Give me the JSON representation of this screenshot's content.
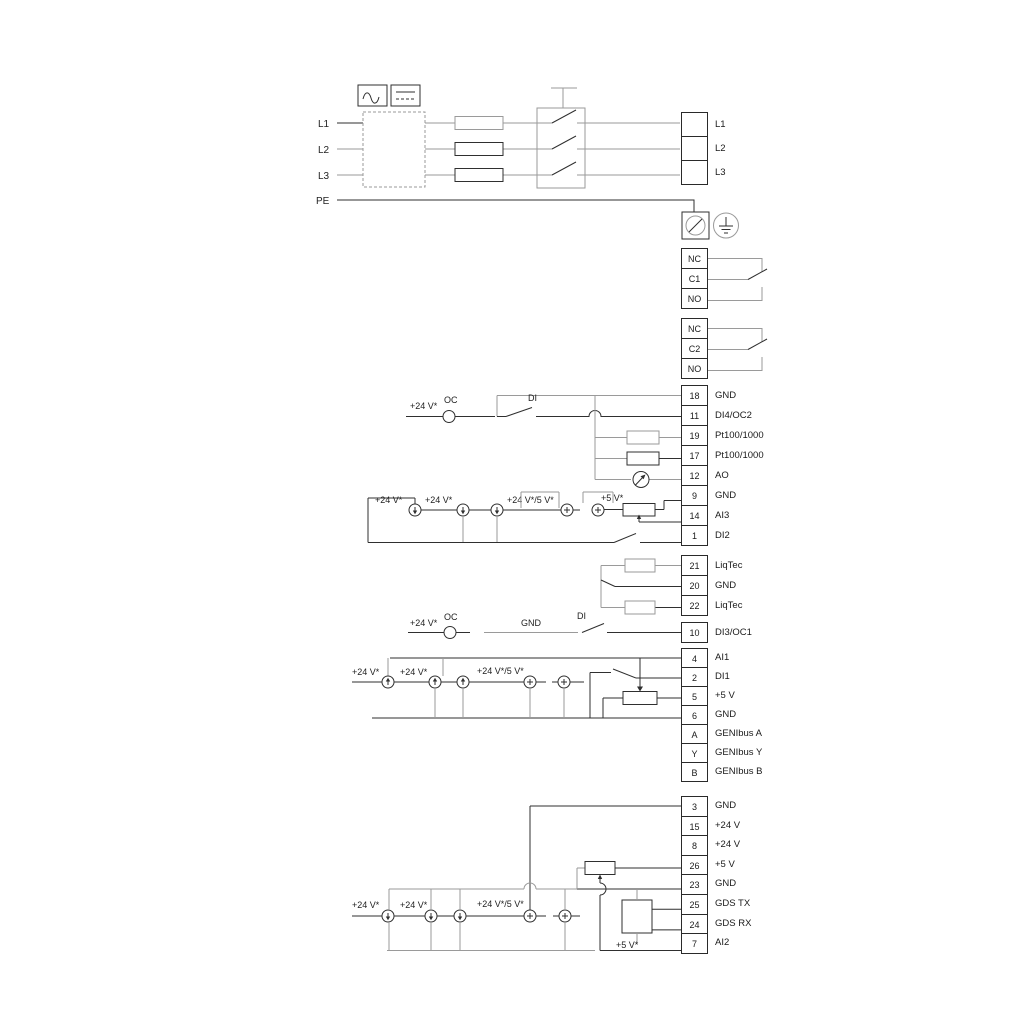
{
  "labels": {
    "l1": "L1",
    "l2": "L2",
    "l3": "L3",
    "pe": "PE",
    "oc": "OC",
    "di": "DI",
    "gnd": "GND",
    "v24": "+24 V*",
    "v24v5": "+24 V*/5 V*",
    "v5": "+5 V*"
  },
  "strips": {
    "power": {
      "type": "power",
      "rows": [
        {
          "num": "",
          "label": "L1"
        },
        {
          "num": "",
          "label": "L2"
        },
        {
          "num": "",
          "label": "L3"
        }
      ]
    },
    "relay1": {
      "type": "relay",
      "rows": [
        {
          "num": "NC"
        },
        {
          "num": "C1"
        },
        {
          "num": "NO"
        }
      ]
    },
    "relay2": {
      "type": "relay",
      "rows": [
        {
          "num": "NC"
        },
        {
          "num": "C2"
        },
        {
          "num": "NO"
        }
      ]
    },
    "io1": {
      "type": "io",
      "rows": [
        {
          "num": "18",
          "label": "GND"
        },
        {
          "num": "11",
          "label": "DI4/OC2"
        },
        {
          "num": "19",
          "label": "Pt100/1000"
        },
        {
          "num": "17",
          "label": "Pt100/1000"
        },
        {
          "num": "12",
          "label": "AO"
        },
        {
          "num": "9",
          "label": "GND"
        },
        {
          "num": "14",
          "label": "AI3"
        },
        {
          "num": "1",
          "label": "DI2"
        }
      ]
    },
    "liqtec": {
      "type": "io",
      "rows": [
        {
          "num": "21",
          "label": "LiqTec"
        },
        {
          "num": "20",
          "label": "GND"
        },
        {
          "num": "22",
          "label": "LiqTec"
        }
      ]
    },
    "io2": {
      "type": "io",
      "rows": [
        {
          "num": "10",
          "label": "DI3/OC1"
        }
      ]
    },
    "io3": {
      "type": "io",
      "rows": [
        {
          "num": "4",
          "label": "AI1"
        },
        {
          "num": "2",
          "label": "DI1"
        },
        {
          "num": "5",
          "label": "+5 V"
        },
        {
          "num": "6",
          "label": "GND"
        },
        {
          "num": "A",
          "label": "GENIbus A"
        },
        {
          "num": "Y",
          "label": "GENIbus Y"
        },
        {
          "num": "B",
          "label": "GENIbus B"
        }
      ]
    },
    "io4": {
      "type": "io",
      "rows": [
        {
          "num": "3",
          "label": "GND"
        },
        {
          "num": "15",
          "label": "+24 V"
        },
        {
          "num": "8",
          "label": "+24 V"
        },
        {
          "num": "26",
          "label": "+5 V"
        },
        {
          "num": "23",
          "label": "GND"
        },
        {
          "num": "25",
          "label": "GDS TX"
        },
        {
          "num": "24",
          "label": "GDS RX"
        },
        {
          "num": "7",
          "label": "AI2"
        }
      ]
    }
  }
}
